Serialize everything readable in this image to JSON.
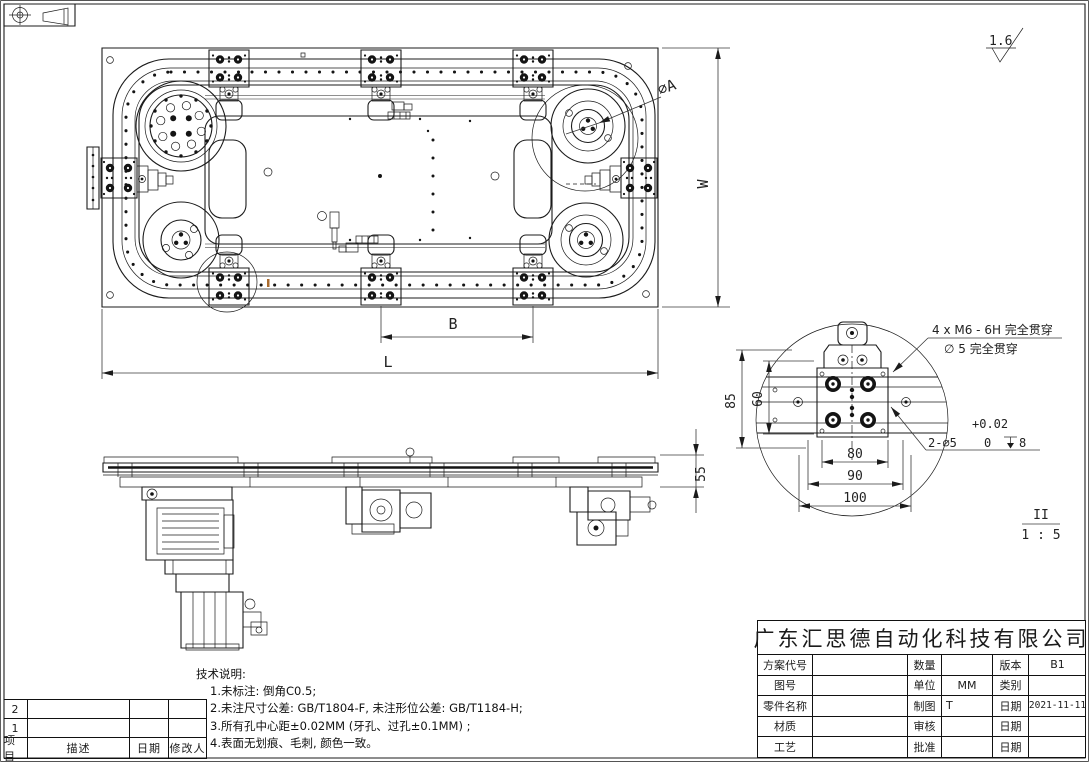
{
  "sheet": {
    "surface_finish": "1.6",
    "projection_symbol": "first-angle-projection"
  },
  "top_view": {
    "dim_dia_a": "∅A",
    "dim_w": "W",
    "dim_b": "B",
    "dim_l": "L"
  },
  "side_view": {
    "dim_55": "55"
  },
  "detail_view": {
    "label": "II",
    "scale": "1 : 5",
    "dim_85": "85",
    "dim_60": "60",
    "dim_80": "80",
    "dim_90": "90",
    "dim_100": "100",
    "note_thread": "4 x M6 - 6H 完全贯穿",
    "note_hole": "∅ 5 完全贯穿",
    "tol_upper": "+0.02",
    "tol_lower": "0",
    "note_pin": "2-∅5",
    "note_depth": "8"
  },
  "tech_notes": {
    "title": "技术说明:",
    "item1": "1.未标注: 倒角C0.5;",
    "item2": "2.未注尺寸公差: GB/T1804-F, 未注形位公差: GB/T1184-H;",
    "item3": "3.所有孔中心距±0.02MM (牙孔、过孔±0.1MM) ;",
    "item4": "4.表面无划痕、毛刺, 颜色一致。"
  },
  "revision_table": {
    "row2_no": "2",
    "row1_no": "1",
    "col_item": "项目",
    "col_desc": "描述",
    "col_date": "日期",
    "col_editor": "修改人"
  },
  "title_block": {
    "company": "广东汇思德自动化科技有限公司",
    "r1c1": "方案代号",
    "r1v1": "",
    "r1c2": "数量",
    "r1v2": "",
    "r1c3": "版本",
    "r1v3": "B1",
    "r2c1": "图号",
    "r2v1": "",
    "r2c2": "单位",
    "r2v2": "MM",
    "r2c3": "类别",
    "r2v3": "",
    "r3c1": "零件名称",
    "r3v1": "",
    "r3c2": "制图",
    "r3v2": "T",
    "r3c3": "日期",
    "r3v3": "2021-11-11",
    "r4c1": "材质",
    "r4v1": "",
    "r4c2": "审核",
    "r4v2": "",
    "r4c3": "日期",
    "r4v3": "",
    "r5c1": "工艺",
    "r5v1": "",
    "r5c2": "批准",
    "r5v2": "",
    "r5c3": "日期",
    "r5v3": ""
  },
  "colors": {
    "line": "#1b1b1b",
    "accent_mark": "#a96a2d"
  }
}
